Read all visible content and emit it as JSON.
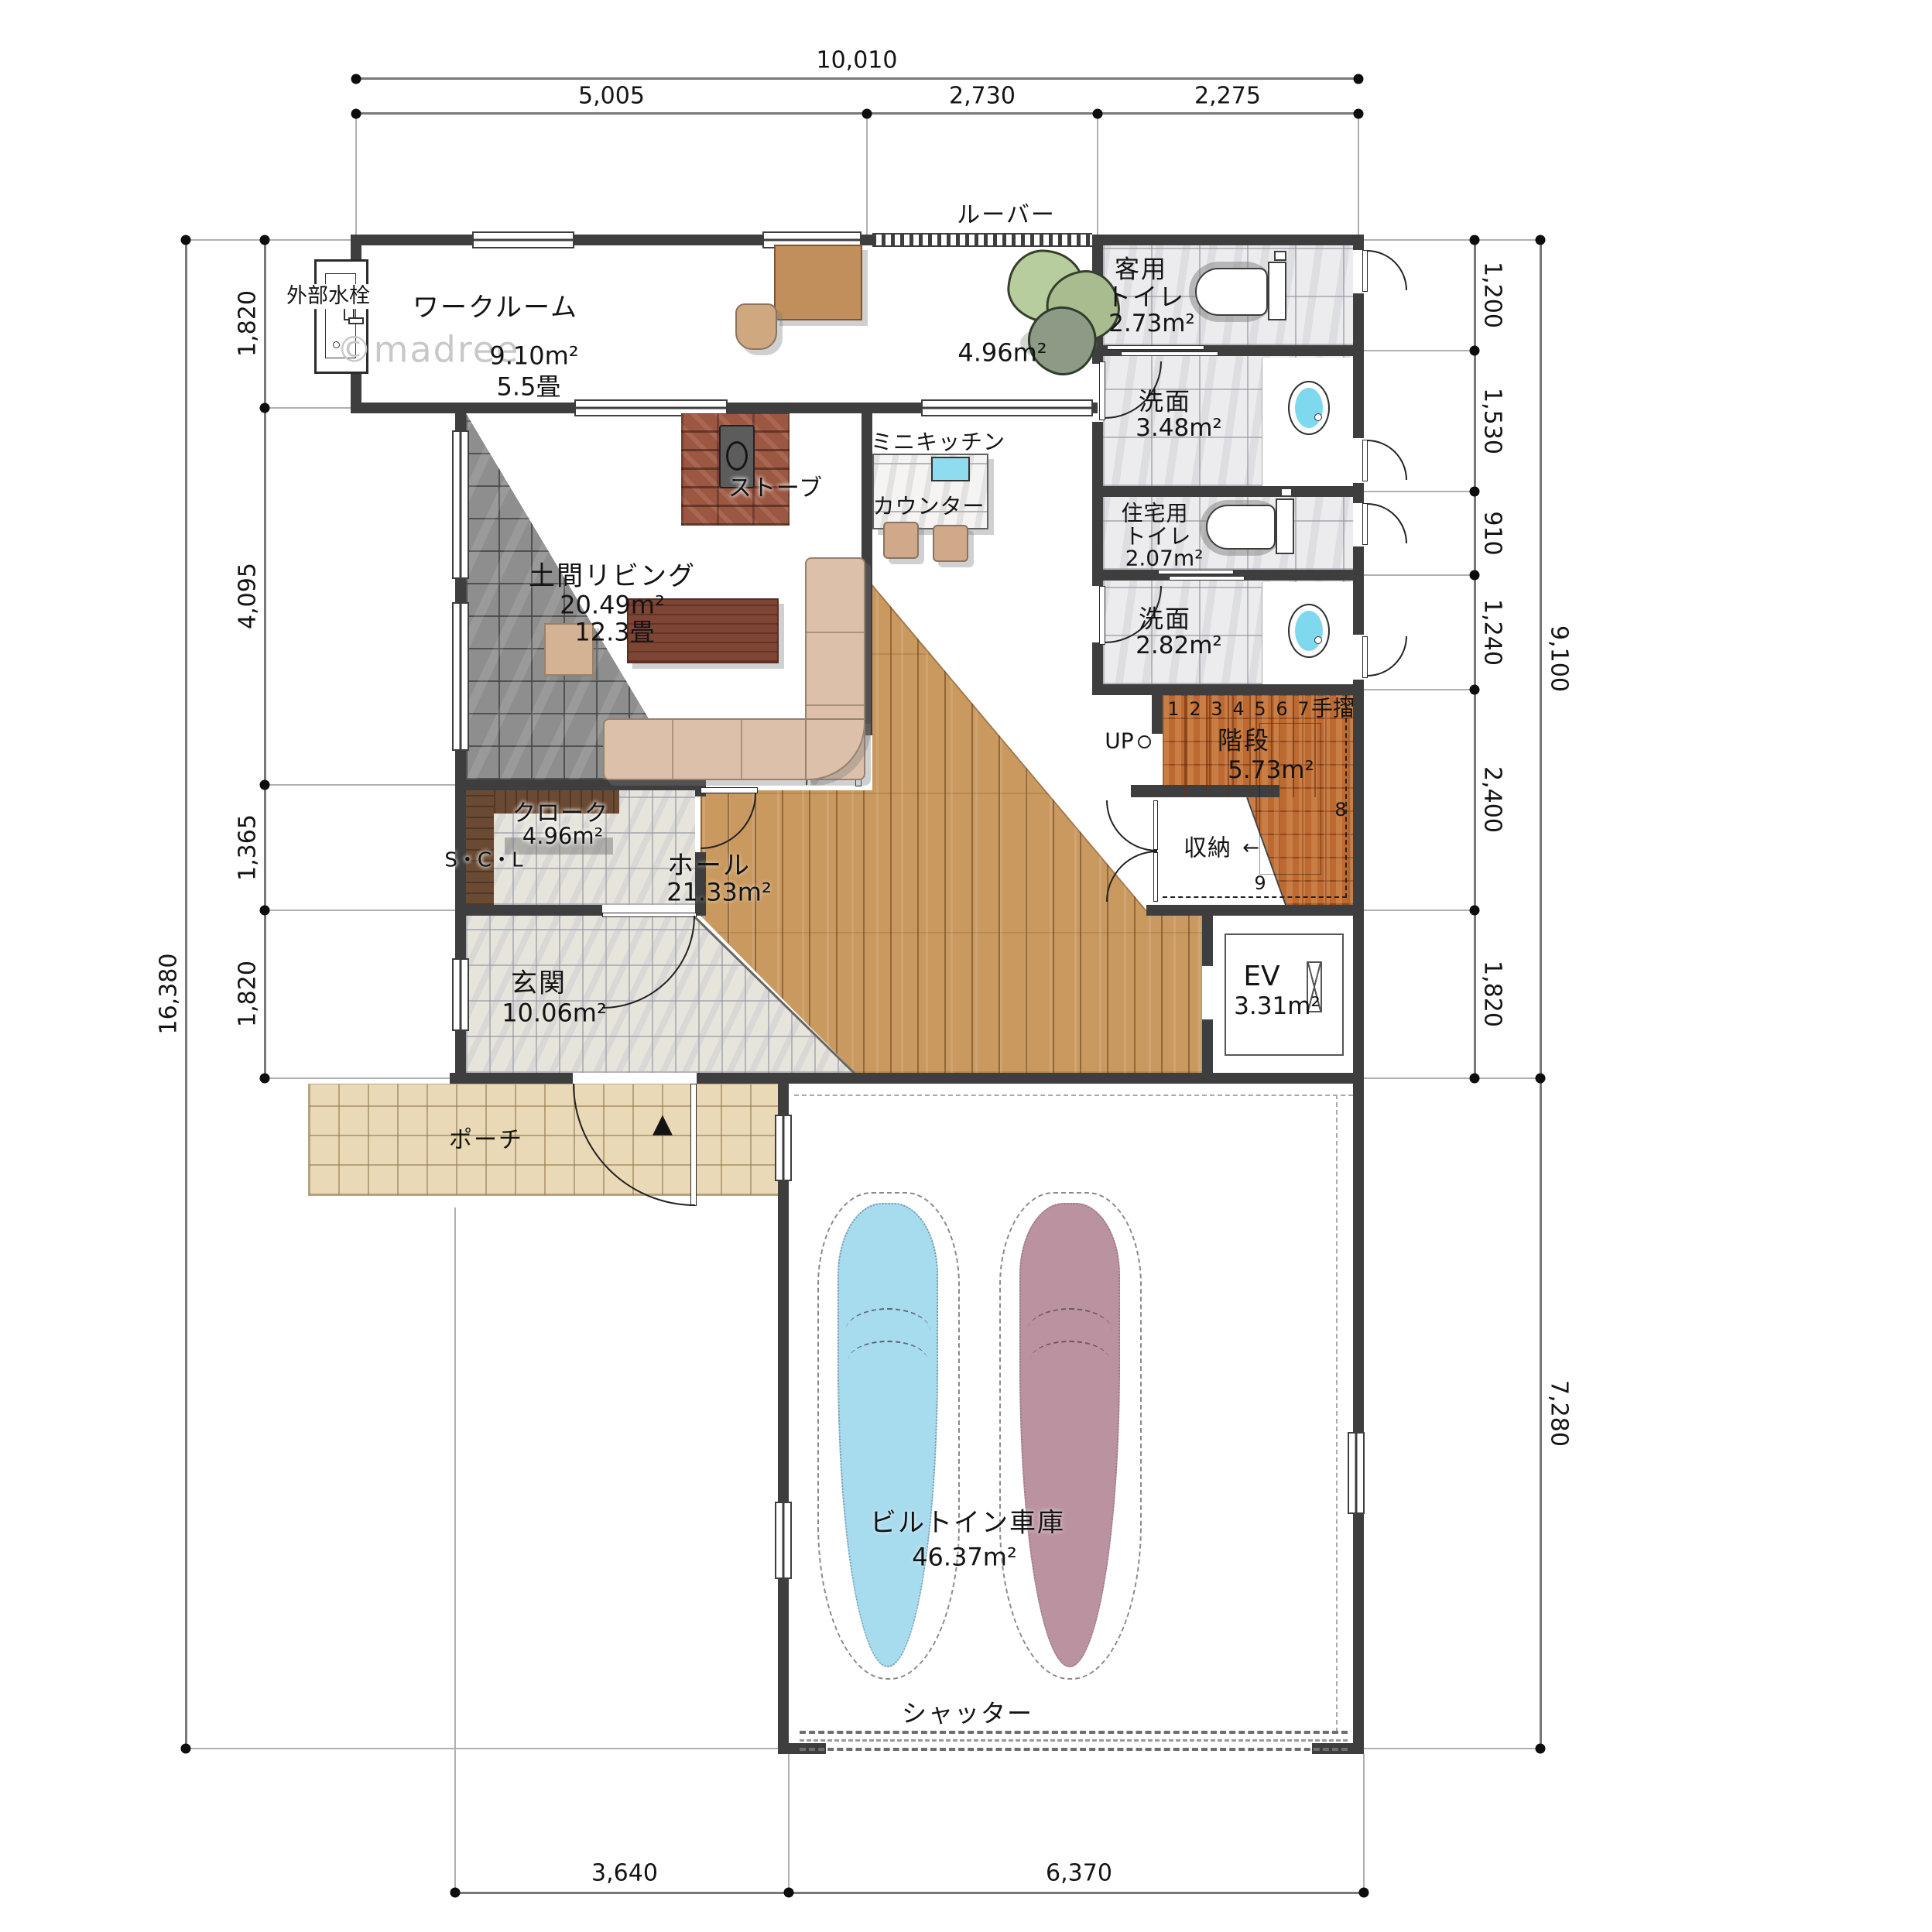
{
  "watermark": "©madree",
  "dims": {
    "top_total": "10,010",
    "top": [
      "5,005",
      "2,730",
      "2,275"
    ],
    "left_total": "16,380",
    "left": [
      "1,820",
      "4,095",
      "1,365",
      "1,820"
    ],
    "right": [
      "1,200",
      "1,530",
      "910",
      "1,240",
      "2,400",
      "1,820"
    ],
    "right_upper_total": "9,100",
    "right_lower_total": "7,280",
    "bottom": [
      "3,640",
      "6,370"
    ]
  },
  "exterior": {
    "faucet": "外部水栓",
    "louver": "ルーバー",
    "terrace_area": "4.96m²"
  },
  "rooms": {
    "workroom": {
      "name": "ワークルーム",
      "area": "9.10m²",
      "tatami": "5.5畳"
    },
    "guest_toilet": {
      "line1": "客用",
      "line2": "トイレ",
      "area": "2.73m²"
    },
    "washroom1": {
      "name": "洗面",
      "area": "3.48m²"
    },
    "home_toilet": {
      "line1": "住宅用",
      "line2": "トイレ",
      "area": "2.07m²"
    },
    "washroom2": {
      "name": "洗面",
      "area": "2.82m²"
    },
    "stairs": {
      "name": "階段",
      "area": "5.73m²",
      "handrail": "手摺",
      "up": "UP",
      "steps": [
        "1",
        "2",
        "3",
        "4",
        "5",
        "6",
        "7"
      ],
      "step8": "8",
      "step9": "9",
      "storage": "収納",
      "storage_arrow": "←"
    },
    "doma_living": {
      "name": "土間リビング",
      "area": "20.49m²",
      "tatami": "12.3畳",
      "stove": "ストーブ"
    },
    "kitchen": {
      "mini_kitchen": "ミニキッチン",
      "counter": "カウンター"
    },
    "cloak": {
      "name": "クローク",
      "area": "4.96m²",
      "scl": "S・C・L"
    },
    "hall": {
      "name": "ホール",
      "area": "21.33m²"
    },
    "entrance": {
      "name": "玄関",
      "area": "10.06m²",
      "porch": "ポーチ",
      "door_arrow": "▲"
    },
    "ev": {
      "name": "EV",
      "area": "3.31m²"
    },
    "garage": {
      "name": "ビルトイン車庫",
      "area": "46.37m²",
      "shutter": "シャッター"
    }
  }
}
